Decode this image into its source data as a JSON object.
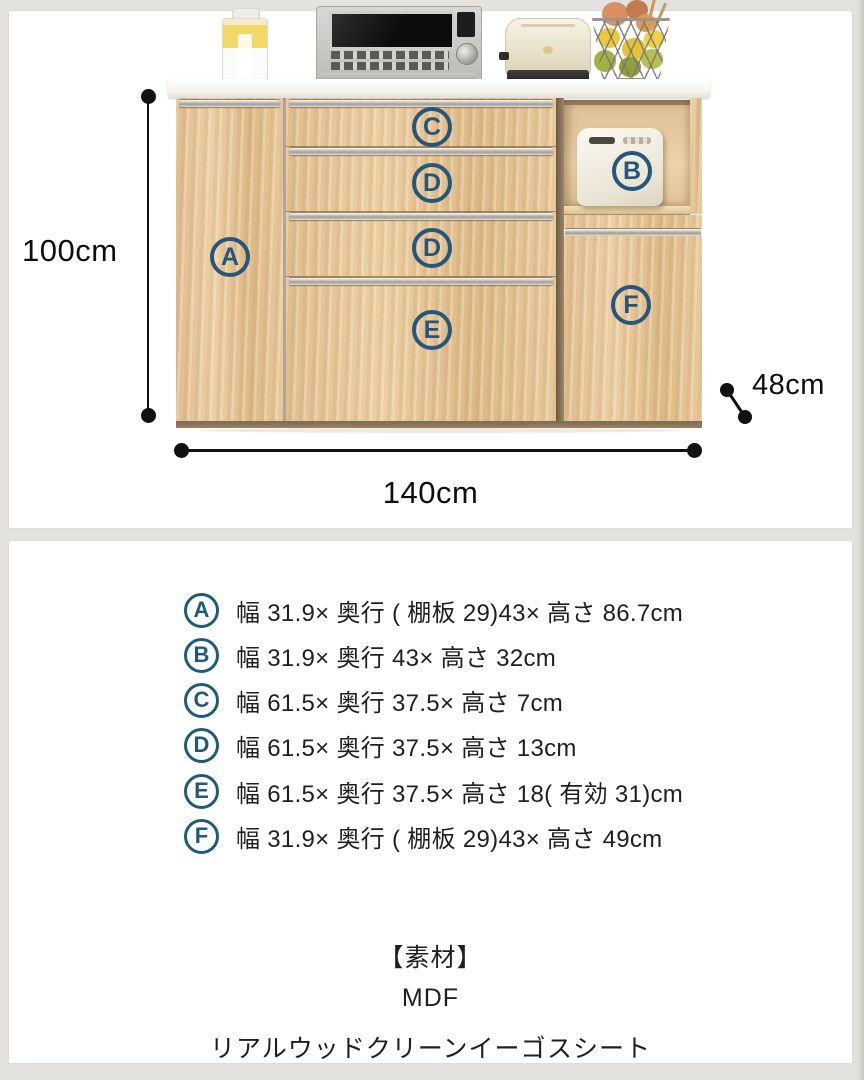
{
  "colors": {
    "page_background": "#e4e2df",
    "card_background": "#ffffff",
    "badge_blue": "#26567c",
    "list_badge_blue": "#1e5a7c",
    "wood": "#e3c194",
    "dimension_line": "#111111"
  },
  "diagram": {
    "height_label": "100cm",
    "width_label": "140cm",
    "depth_label": "48cm",
    "part_labels": {
      "a": "A",
      "b": "B",
      "c": "C",
      "d": "D",
      "e": "E",
      "f": "F"
    },
    "decorations": [
      "juice-bottle",
      "microwave-oven",
      "toaster",
      "fruit-basket",
      "rice-cooker"
    ]
  },
  "specs": [
    {
      "letter": "A",
      "text": "幅 31.9× 奥行 ( 棚板 29)43× 高さ 86.7cm"
    },
    {
      "letter": "B",
      "text": "幅 31.9× 奥行 43× 高さ 32cm"
    },
    {
      "letter": "C",
      "text": "幅 61.5× 奥行 37.5× 高さ 7cm"
    },
    {
      "letter": "D",
      "text": "幅 61.5× 奥行 37.5× 高さ 13cm"
    },
    {
      "letter": "E",
      "text": "幅 61.5× 奥行 37.5× 高さ 18( 有効 31)cm"
    },
    {
      "letter": "F",
      "text": "幅 31.9× 奥行 ( 棚板 29)43× 高さ 49cm"
    }
  ],
  "material": {
    "heading": "【素材】",
    "lines": [
      "MDF",
      "リアルウッドクリーンイーゴスシート"
    ]
  }
}
